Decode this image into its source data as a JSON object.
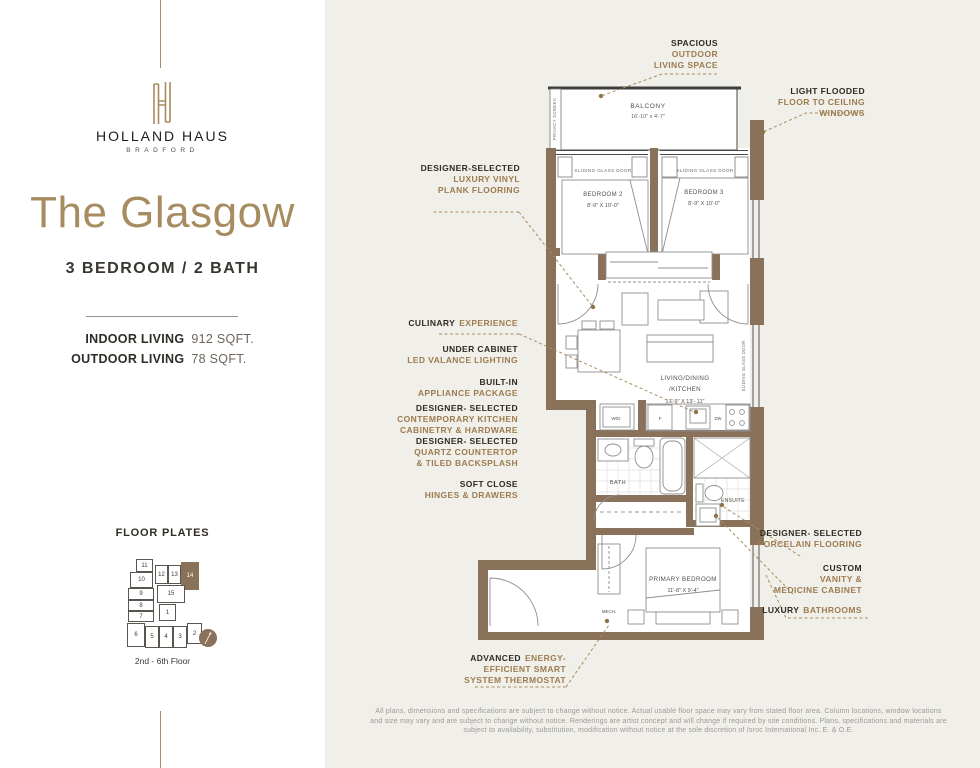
{
  "colors": {
    "accent_gold": "#a78c60",
    "callout_brown": "#9c7c50",
    "callout_dark": "#2e2b27",
    "wall_brown": "#8a7159",
    "panel_beige": "#f1efe9",
    "sidebar_white": "#ffffff"
  },
  "brand": {
    "monogram": "H",
    "name": "HOLLAND HAUS",
    "location": "BRADFORD"
  },
  "unit": {
    "name": "The Glasgow",
    "type": "3 BEDROOM / 2 BATH",
    "indoor_label": "INDOOR LIVING",
    "indoor_value": "912 SQFT.",
    "outdoor_label": "OUTDOOR LIVING",
    "outdoor_value": "78 SQFT."
  },
  "floor_plates": {
    "title": "FLOOR PLATES",
    "caption": "2nd - 6th Floor",
    "highlighted": "14",
    "units": [
      "11",
      "12",
      "13",
      "14",
      "10",
      "9",
      "15",
      "8",
      "7",
      "1",
      "6",
      "5",
      "4",
      "3",
      "2"
    ]
  },
  "plan": {
    "balcony": {
      "name": "BALCONY",
      "dims": "16'-10\" x 4'-7\""
    },
    "privacy_screen": "PRIVACY SCREEN",
    "sliding_glass_door": "SLIDING GLASS DOOR",
    "bedroom2": {
      "name": "BEDROOM 2",
      "dims": "8'-9\" X 10'-0\""
    },
    "bedroom3": {
      "name": "BEDROOM 3",
      "dims": "8'-9\" X 10'-0\""
    },
    "living": {
      "line1": "LIVING/DINING",
      "line2": "/KITCHEN",
      "dims": "17'-9\" X 13'- 11\""
    },
    "bath": "BATH",
    "ensuite": "ENSUITE",
    "primary": {
      "name": "PRIMARY BEDROOM",
      "dims": "11'-8\" X 9'-4\""
    },
    "mech": "MECH.",
    "wd": "W/D",
    "fridge": "F",
    "dw": "DW"
  },
  "callouts": {
    "spacious": {
      "l1": "SPACIOUS",
      "l2": "OUTDOOR",
      "l3": "LIVING SPACE"
    },
    "light_flooded": {
      "l1": "LIGHT FLOODED",
      "l2": "FLOOR TO CEILING",
      "l3": "WINDOWS"
    },
    "vinyl": {
      "l1": "DESIGNER-SELECTED",
      "l2": "LUXURY VINYL",
      "l3": "PLANK FLOORING"
    },
    "culinary": {
      "l1": "CULINARY",
      "l2": "EXPERIENCE"
    },
    "under_cabinet": {
      "l1": "UNDER CABINET",
      "l2": "LED VALANCE LIGHTING"
    },
    "built_in": {
      "l1": "BUILT-IN",
      "l2": "APPLIANCE PACKAGE"
    },
    "cabinetry": {
      "l1": "DESIGNER- SELECTED",
      "l2": "CONTEMPORARY KITCHEN",
      "l3": "CABINETRY & HARDWARE"
    },
    "quartz": {
      "l1": "DESIGNER- SELECTED",
      "l2": "QUARTZ COUNTERTOP",
      "l3": "& TILED BACKSPLASH"
    },
    "soft_close": {
      "l1": "SOFT CLOSE",
      "l2": "HINGES & DRAWERS"
    },
    "porcelain": {
      "l1": "DESIGNER- SELECTED",
      "l2": "PORCELAIN FLOORING"
    },
    "vanity": {
      "l1": "CUSTOM",
      "l2": "VANITY &",
      "l3": "MEDICINE CABINET"
    },
    "luxury": {
      "l1": "LUXURY",
      "l2": "BATHROOMS"
    },
    "thermostat": {
      "l1": "ADVANCED",
      "l2": "ENERGY-",
      "l3": "EFFICIENT SMART",
      "l4": "SYSTEM THERMOSTAT"
    }
  },
  "disclaimer": {
    "line1": "All plans, dimensions and specifications are subject to change without notice. Actual usable floor space may vary from stated floor area. Column locations, window locations",
    "line2": "and size may vary and are subject to change without notice. Renderings are artist concept and will change if required by site conditions. Plans, specifications and materials are",
    "line3": "subject to availability, substitution, modification without notice at the sole discretion of Isroc International Inc. E. & O.E."
  }
}
